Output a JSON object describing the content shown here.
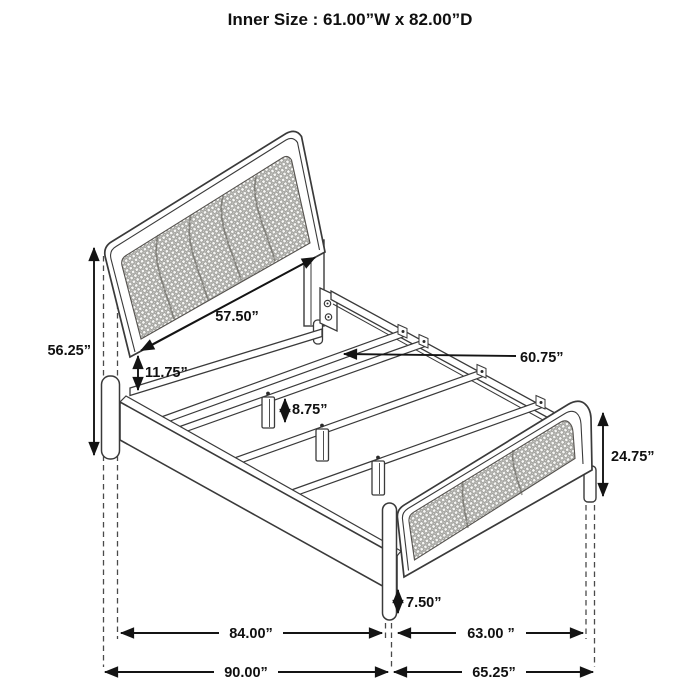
{
  "title": "Inner Size : 61.00”W x 82.00”D",
  "diagram": {
    "subject": "bed frame dimension diagram",
    "labels": {
      "headboard_height": "56.25”",
      "headboard_rail": "57.50”",
      "headboard_clearance": "11.75”",
      "slat_length": "60.75”",
      "support_leg_height": "8.75”",
      "footboard_height": "24.75”",
      "footboard_leg_height": "7.50”",
      "rail_span": "84.00”",
      "footboard_span": "63.00 ”",
      "overall_depth": "90.00”",
      "overall_width": "65.25”"
    }
  }
}
